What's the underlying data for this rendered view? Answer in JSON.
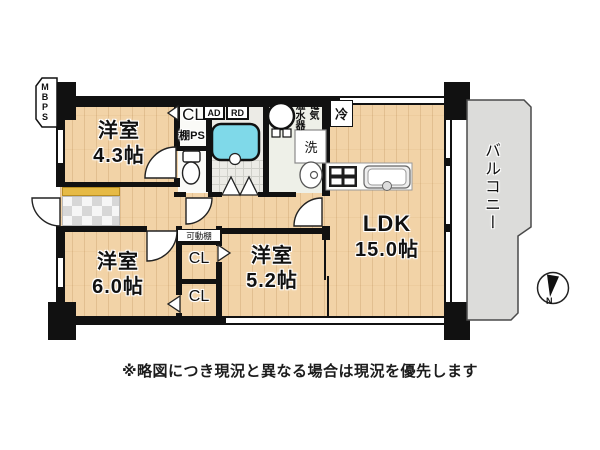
{
  "floorplan": {
    "rooms": [
      {
        "name": "洋室",
        "size": "4.3帖"
      },
      {
        "name": "洋室",
        "size": "6.0帖"
      },
      {
        "name": "洋室",
        "size": "5.2帖"
      },
      {
        "name": "LDK",
        "size": "15.0帖"
      }
    ],
    "labels": {
      "balcony": "バルコニー",
      "mbps": "MBPS",
      "closet_hall": "CL",
      "shelf_ps": "棚PS",
      "ad": "AD",
      "rd": "RD",
      "electric": "電気",
      "water_heater": "温水器",
      "fridge": "冷",
      "washer": "洗",
      "movable_shelf": "可動棚",
      "closet_top": "CL",
      "closet_bottom": "CL",
      "north": "N"
    },
    "caption": "※略図につき現況と異なる場合は現況を優先します",
    "colors": {
      "wall": "#111111",
      "wood_floor": "#f2d3a7",
      "bathtub": "#7fd9e9",
      "balcony_floor": "#dcdcda",
      "entrance_step": "#e6ba45",
      "tile": "#d7d7d7"
    }
  }
}
